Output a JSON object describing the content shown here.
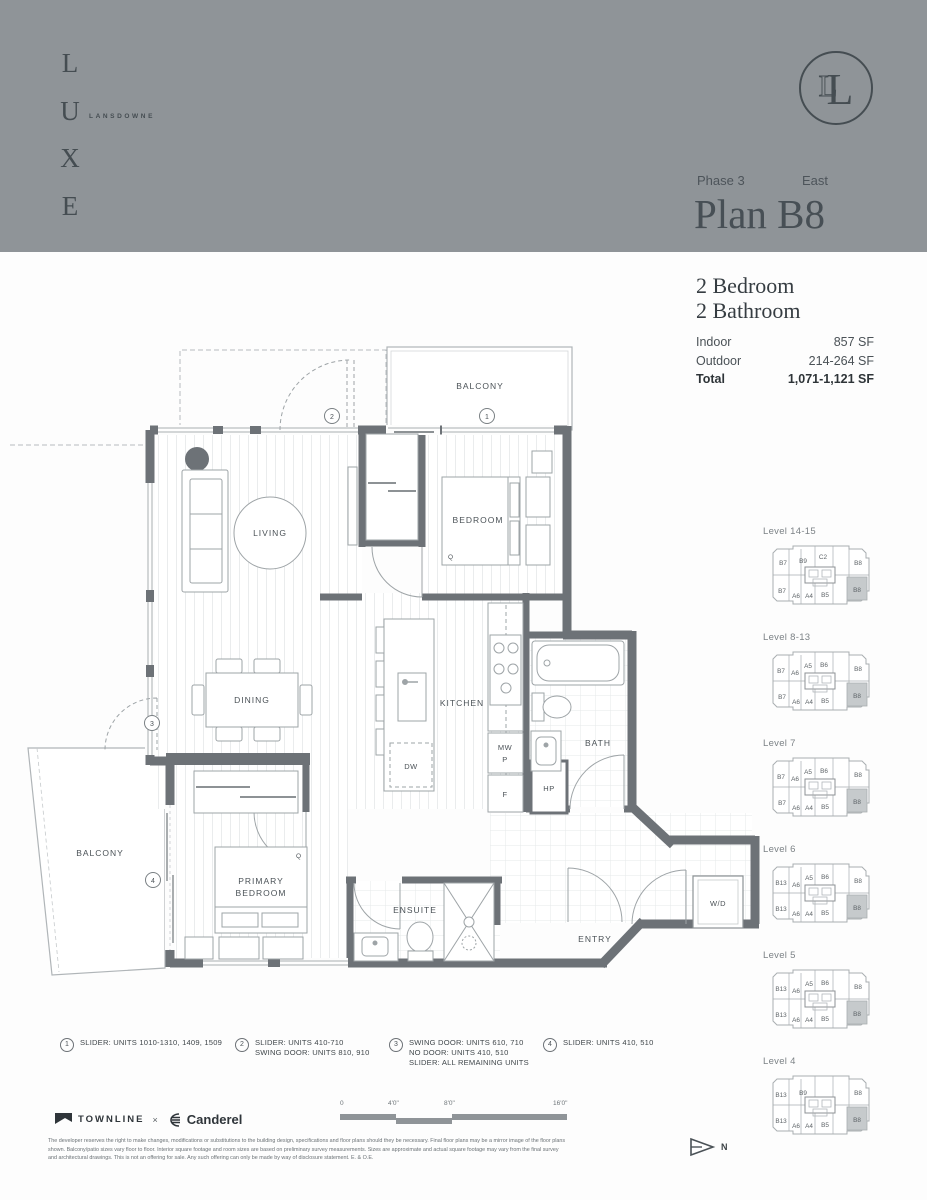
{
  "header": {
    "brand_letters": "L U X E",
    "brand_sub": "LANSDOWNE",
    "logo_monogram": "L",
    "phase_label": "Phase 3",
    "orientation_label": "East",
    "plan_title": "Plan B8"
  },
  "summary": {
    "bedrooms": "2 Bedroom",
    "bathrooms": "2 Bathroom",
    "rows": [
      {
        "label": "Indoor",
        "value": "857 SF"
      },
      {
        "label": "Outdoor",
        "value": "214-264 SF"
      },
      {
        "label": "Total",
        "value": "1,071-1,121 SF"
      }
    ]
  },
  "floorplan": {
    "rooms": {
      "living": "LIVING",
      "dining": "DINING",
      "kitchen": "KITCHEN",
      "bedroom": "BEDROOM",
      "primary_line1": "PRIMARY",
      "primary_line2": "BEDROOM",
      "bath": "BATH",
      "ensuite": "ENSUITE",
      "entry": "ENTRY",
      "balcony_top": "BALCONY",
      "balcony_left": "BALCONY"
    },
    "fixtures": {
      "dw": "DW",
      "mw": "MW",
      "p": "P",
      "f": "F",
      "hp": "HP",
      "wd": "W/D",
      "q": "Q"
    },
    "callouts": [
      "1",
      "2",
      "3",
      "4"
    ]
  },
  "notes": [
    {
      "num": "1",
      "lines": [
        "SLIDER: UNITS 1010-1310, 1409, 1509"
      ]
    },
    {
      "num": "2",
      "lines": [
        "SLIDER: UNITS 410-710",
        "SWING DOOR: UNITS 810, 910"
      ]
    },
    {
      "num": "3",
      "lines": [
        "SWING DOOR: UNITS 610, 710",
        "NO DOOR: UNITS 410, 510",
        "SLIDER: ALL REMAINING UNITS"
      ]
    },
    {
      "num": "4",
      "lines": [
        "SLIDER: UNITS 410, 510"
      ]
    }
  ],
  "keyplans": [
    {
      "level": "Level 14-15",
      "highlight": "B8",
      "units": [
        {
          "t": "B7",
          "x": 20,
          "y": 24
        },
        {
          "t": "B9",
          "x": 40,
          "y": 22
        },
        {
          "t": "C2",
          "x": 60,
          "y": 18
        },
        {
          "t": "B8",
          "x": 95,
          "y": 24
        },
        {
          "t": "B7",
          "x": 19,
          "y": 52
        },
        {
          "t": "A6",
          "x": 33,
          "y": 57
        },
        {
          "t": "A4",
          "x": 46,
          "y": 57
        },
        {
          "t": "B5",
          "x": 62,
          "y": 56
        },
        {
          "t": "B8",
          "x": 94,
          "y": 51
        }
      ]
    },
    {
      "level": "Level 8-13",
      "highlight": "B8",
      "units": [
        {
          "t": "B7",
          "x": 18,
          "y": 26
        },
        {
          "t": "A6",
          "x": 32,
          "y": 28
        },
        {
          "t": "A5",
          "x": 45,
          "y": 21
        },
        {
          "t": "B6",
          "x": 61,
          "y": 20
        },
        {
          "t": "B8",
          "x": 95,
          "y": 24
        },
        {
          "t": "B7",
          "x": 19,
          "y": 52
        },
        {
          "t": "A6",
          "x": 33,
          "y": 57
        },
        {
          "t": "A4",
          "x": 46,
          "y": 57
        },
        {
          "t": "B5",
          "x": 62,
          "y": 56
        },
        {
          "t": "B8",
          "x": 94,
          "y": 51
        }
      ]
    },
    {
      "level": "Level 7",
      "highlight": "B8",
      "units": [
        {
          "t": "B7",
          "x": 18,
          "y": 26
        },
        {
          "t": "A6",
          "x": 32,
          "y": 28
        },
        {
          "t": "A5",
          "x": 45,
          "y": 21
        },
        {
          "t": "B6",
          "x": 61,
          "y": 20
        },
        {
          "t": "B8",
          "x": 95,
          "y": 24
        },
        {
          "t": "B7",
          "x": 19,
          "y": 52
        },
        {
          "t": "A6",
          "x": 33,
          "y": 57
        },
        {
          "t": "A4",
          "x": 46,
          "y": 57
        },
        {
          "t": "B5",
          "x": 62,
          "y": 56
        },
        {
          "t": "B8",
          "x": 94,
          "y": 51
        }
      ]
    },
    {
      "level": "Level 6",
      "highlight": "B8",
      "units": [
        {
          "t": "B13",
          "x": 18,
          "y": 26
        },
        {
          "t": "A6",
          "x": 33,
          "y": 28
        },
        {
          "t": "A5",
          "x": 46,
          "y": 21
        },
        {
          "t": "B6",
          "x": 62,
          "y": 20
        },
        {
          "t": "B8",
          "x": 95,
          "y": 24
        },
        {
          "t": "B13",
          "x": 18,
          "y": 52
        },
        {
          "t": "A6",
          "x": 33,
          "y": 57
        },
        {
          "t": "A4",
          "x": 46,
          "y": 57
        },
        {
          "t": "B5",
          "x": 62,
          "y": 56
        },
        {
          "t": "B8",
          "x": 94,
          "y": 51
        }
      ]
    },
    {
      "level": "Level 5",
      "highlight": "B8",
      "units": [
        {
          "t": "B13",
          "x": 18,
          "y": 26
        },
        {
          "t": "A6",
          "x": 33,
          "y": 28
        },
        {
          "t": "A5",
          "x": 46,
          "y": 21
        },
        {
          "t": "B6",
          "x": 62,
          "y": 20
        },
        {
          "t": "B8",
          "x": 95,
          "y": 24
        },
        {
          "t": "B13",
          "x": 18,
          "y": 52
        },
        {
          "t": "A6",
          "x": 33,
          "y": 57
        },
        {
          "t": "A4",
          "x": 46,
          "y": 57
        },
        {
          "t": "B5",
          "x": 62,
          "y": 56
        },
        {
          "t": "B8",
          "x": 94,
          "y": 51
        }
      ]
    },
    {
      "level": "Level 4",
      "highlight": "B8",
      "units": [
        {
          "t": "B13",
          "x": 18,
          "y": 26
        },
        {
          "t": "B9",
          "x": 40,
          "y": 24
        },
        {
          "t": "B8",
          "x": 95,
          "y": 24
        },
        {
          "t": "B13",
          "x": 18,
          "y": 52
        },
        {
          "t": "A6",
          "x": 33,
          "y": 57
        },
        {
          "t": "A4",
          "x": 46,
          "y": 57
        },
        {
          "t": "B5",
          "x": 62,
          "y": 56
        },
        {
          "t": "B8",
          "x": 94,
          "y": 51
        }
      ]
    }
  ],
  "footer": {
    "brand_left": "TOWNLINE",
    "brand_sep": "×",
    "brand_right": "Canderel",
    "scale_labels": [
      "0",
      "4'0\"",
      "8'0\"",
      "16'0\""
    ],
    "north_label": "N",
    "disclaimer": "The developer reserves the right to make changes, modifications or substitutions to the building design, specifications and floor plans should they be necessary. Final floor plans may be a mirror image of the floor plans shown. Balcony/patio sizes vary floor to floor. Interior square footage and room sizes are based on preliminary survey measurements. Sizes are approximate and actual square footage may vary from the final survey and architectural drawings. This is not an offering for sale. Any such offering can only be made by way of disclosure statement. E. & O.E."
  }
}
